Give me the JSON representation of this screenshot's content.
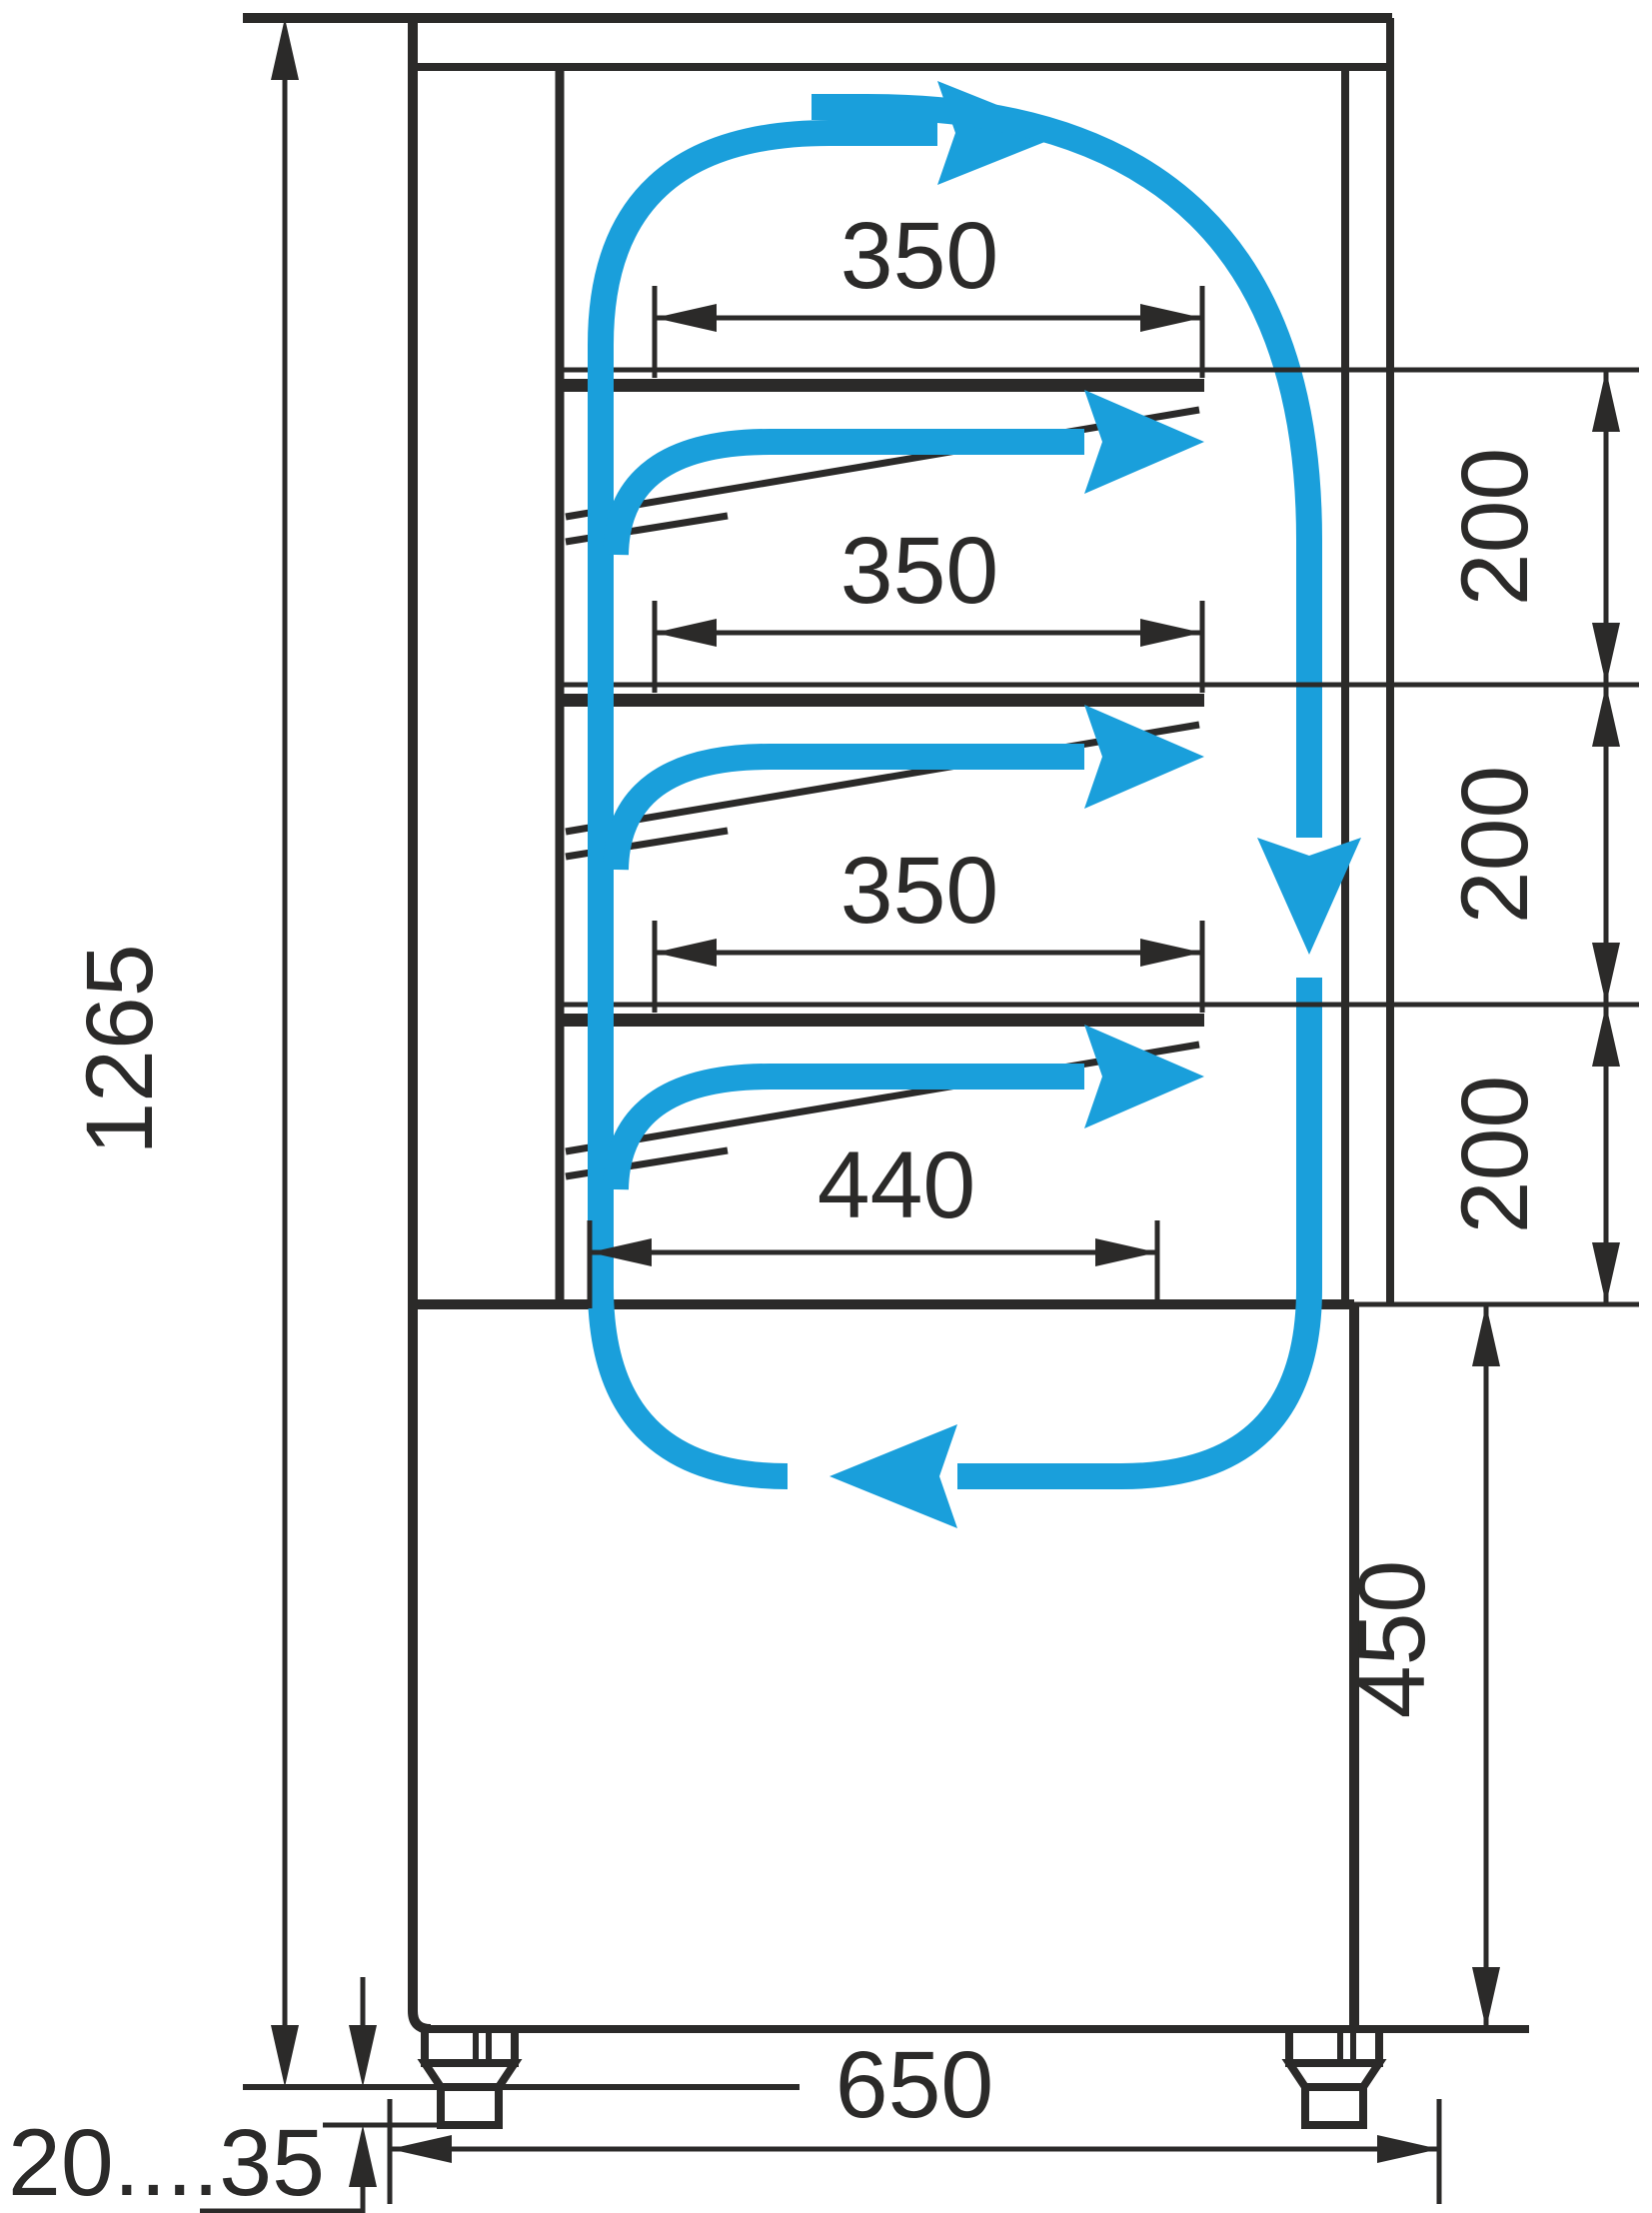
{
  "drawing": {
    "type": "technical-dimension-diagram",
    "subject": "refrigerated-display-case-side-section-with-airflow",
    "colors": {
      "line": "#2b2a29",
      "airflow": "#1a9fdb",
      "background": "#ffffff"
    },
    "dimensions": {
      "height_overall": "1265",
      "shelf1_depth": "350",
      "shelf2_depth": "350",
      "shelf3_depth": "350",
      "gap1": "200",
      "gap2": "200",
      "gap3": "200",
      "bottom_shelf_depth": "440",
      "base_height": "450",
      "depth_overall": "650",
      "feet_adjust_range": "20....35"
    }
  }
}
